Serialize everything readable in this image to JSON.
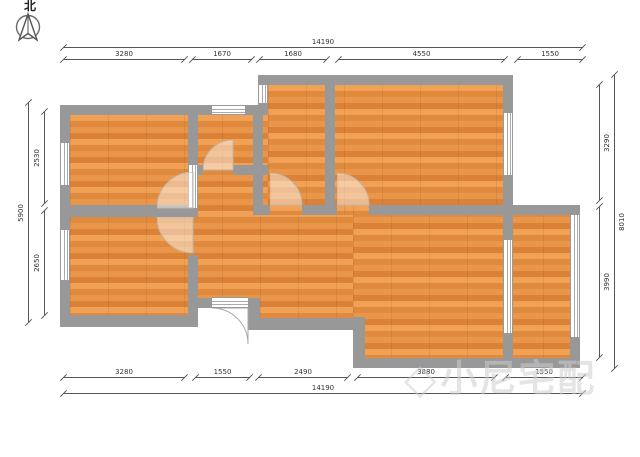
{
  "compass": {
    "label": "北"
  },
  "watermark": {
    "logo": "◇",
    "text": "小尼宅配"
  },
  "dimensions": {
    "top_total": "14190",
    "top_segments": [
      "3280",
      "1670",
      "1680",
      "4550",
      "1550"
    ],
    "bottom_segments": [
      "3280",
      "1550",
      "2490",
      "3880",
      "1550"
    ],
    "bottom_total": "14190",
    "left_total": "5900",
    "left_segments": [
      "2530",
      "2650"
    ],
    "right_segments": [
      "3290",
      "3990"
    ],
    "right_total": "8010"
  },
  "colors": {
    "wall": "#989898",
    "floor_light": "#f0a155",
    "floor_dark": "#db8138",
    "dimension_line": "#555555",
    "watermark": "#d0d0d0"
  }
}
